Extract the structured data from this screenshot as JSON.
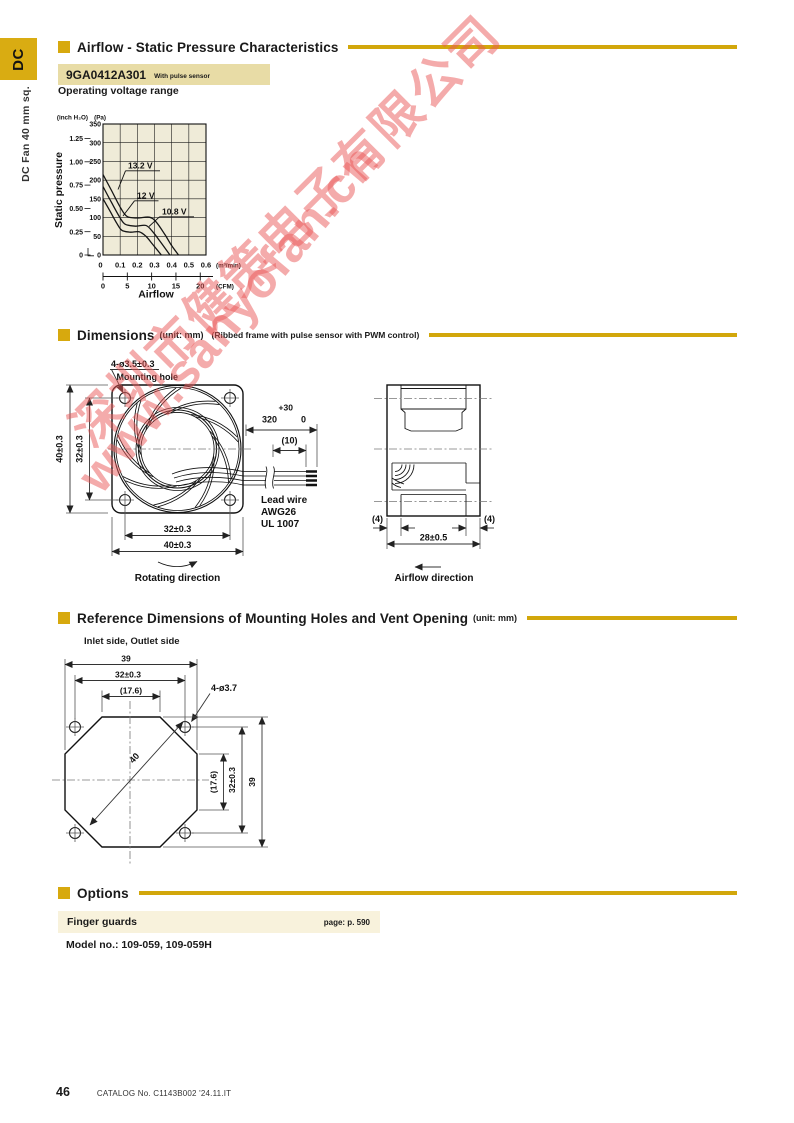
{
  "sidebar": {
    "tab": "DC",
    "vertical_label": "DC Fan 40 mm sq."
  },
  "watermark": {
    "line1": "深圳市健策电子有限公司",
    "line2": "www.sanyofan.cn",
    "color": "#E85858"
  },
  "sections": {
    "airflow": {
      "title": "Airflow - Static Pressure Characteristics"
    },
    "dimensions": {
      "title": "Dimensions",
      "unit": "(unit: mm)",
      "note": "(Ribbed frame with pulse sensor with PWM control)"
    },
    "reference": {
      "title": "Reference Dimensions of Mounting Holes and Vent Opening",
      "unit": "(unit: mm)"
    },
    "options": {
      "title": "Options"
    }
  },
  "model": {
    "number": "9GA0412A301",
    "variant": "With pulse sensor"
  },
  "chart_data": {
    "type": "line",
    "title": "Operating voltage range",
    "xlabel": "Airflow",
    "ylabel": "Static pressure",
    "x_unit_primary": "(m³/min)",
    "x_unit_secondary": "(CFM)",
    "y_unit_primary": "(Pa)",
    "y_unit_secondary": "(inch H₂O)",
    "xlim": [
      0,
      0.6
    ],
    "ylim": [
      0,
      350
    ],
    "grid": true,
    "x_ticks_m3min": [
      "0",
      "0.1",
      "0.2",
      "0.3",
      "0.4",
      "0.5",
      "0.6"
    ],
    "x_ticks_cfm": [
      "0",
      "5",
      "10",
      "15",
      "20"
    ],
    "y_ticks_pa": [
      "350",
      "300",
      "250",
      "200",
      "150",
      "100",
      "50",
      "0"
    ],
    "y_ticks_inch": [
      "1.25",
      "1.00",
      "0.75",
      "0.50",
      "0.25",
      "0"
    ],
    "series": [
      {
        "name": "13.2 V",
        "points": [
          [
            0,
            215
          ],
          [
            0.05,
            172
          ],
          [
            0.1,
            128
          ],
          [
            0.14,
            103
          ],
          [
            0.2,
            99
          ],
          [
            0.27,
            101
          ],
          [
            0.31,
            88
          ],
          [
            0.36,
            55
          ],
          [
            0.4,
            25
          ],
          [
            0.44,
            0
          ]
        ]
      },
      {
        "name": "12 V",
        "points": [
          [
            0,
            183
          ],
          [
            0.05,
            140
          ],
          [
            0.1,
            99
          ],
          [
            0.13,
            82
          ],
          [
            0.19,
            77
          ],
          [
            0.25,
            79
          ],
          [
            0.29,
            62
          ],
          [
            0.33,
            38
          ],
          [
            0.39,
            0
          ]
        ]
      },
      {
        "name": "10.8 V",
        "points": [
          [
            0,
            150
          ],
          [
            0.04,
            118
          ],
          [
            0.08,
            85
          ],
          [
            0.11,
            66
          ],
          [
            0.16,
            61
          ],
          [
            0.21,
            62
          ],
          [
            0.25,
            50
          ],
          [
            0.29,
            28
          ],
          [
            0.34,
            0
          ]
        ]
      }
    ]
  },
  "dims_front": {
    "hole_note": "4-ø3.5±0.3",
    "hole_note2": "Mounting hole",
    "h_outer": "40±0.3",
    "h_inner": "32±0.3",
    "w_inner": "32±0.3",
    "w_outer": "40±0.3",
    "lead_plus": "+30",
    "lead_len": "320",
    "lead_zero": "0",
    "lead_strip": "(10)",
    "lead1": "Lead wire",
    "lead2": "AWG26",
    "lead3": "UL 1007",
    "rotating": "Rotating direction"
  },
  "dims_side": {
    "depth": "28±0.5",
    "flange_l": "(4)",
    "flange_r": "(4)",
    "airflow": "Airflow direction"
  },
  "reference": {
    "caption": "Inlet side, Outlet side",
    "top_w": "39",
    "top_pitch": "32±0.3",
    "top_vent": "(17.6)",
    "hole_note": "4-ø3.7",
    "diagonal": "40",
    "right_vent": "(17.6)",
    "right_pitch": "32±0.3",
    "right_h": "39"
  },
  "options": {
    "item": "Finger guards",
    "page_ref": "page: p. 590",
    "model_no": "Model no.: 109-059, 109-059H"
  },
  "footer": {
    "page_number": "46",
    "catalog": "CATALOG No. C1143B002 '24.11.IT"
  },
  "colors": {
    "accent_gold": "#D2A70B",
    "model_bar_bg": "#E8DCA6",
    "options_bar_bg": "#F8F2DC",
    "chart_bg": "#EFEBD8"
  }
}
